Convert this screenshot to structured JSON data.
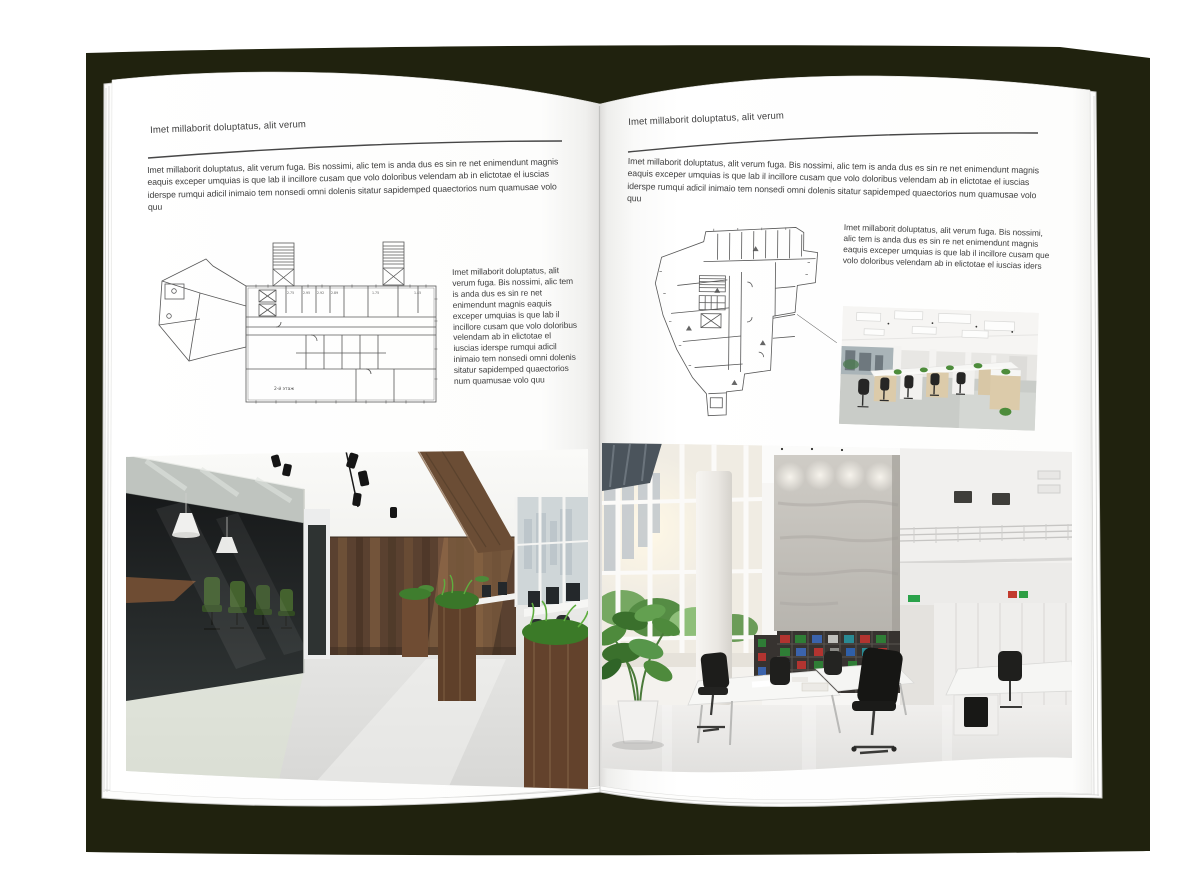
{
  "book": {
    "cover_color": "#20220e",
    "page_color": "#ffffff",
    "rule_color": "#474747",
    "text_color": "#404040"
  },
  "left_page": {
    "header": "Imet millaborit doluptatus, alit verum",
    "intro": "Imet millaborit doluptatus, alit verum fuga. Bis nossimi, alic tem is anda dus es sin re net enimendunt magnis eaquis exceper umquias is que lab il incillore cusam que volo doloribus velendam ab in elictotae el iuscias iderspe rumqui adicil inimaio tem nonsedi omni dolenis sitatur sapidemped quaectorios num quamusae volo quu",
    "side_text": "Imet millaborit doluptatus, alit verum fuga. Bis nossimi, alic tem is anda dus es sin re net enimendunt magnis eaquis exceper umquias is que lab il incillore cusam que volo doloribus velendam ab in elictotae el iuscias iderspe rumqui adicil inimaio tem nonsedi omni dolenis sitatur sapidemped quaectorios num quamusae volo quu",
    "plan_dimensions": [
      "2.75",
      "2.95",
      "2.92",
      "2.89",
      "1.75",
      "1.45"
    ],
    "plan_floor_label": "2-й этаж"
  },
  "right_page": {
    "header": "Imet millaborit doluptatus, alit verum",
    "intro": "Imet millaborit doluptatus, alit verum fuga. Bis nossimi, alic tem is anda dus es sin re net enimendunt magnis eaquis exceper umquias is que lab il incillore cusam que volo doloribus velendam ab in elictotae el iuscias iderspe rumqui adicil inimaio tem nonsedi omni dolenis sitatur sapidemped quaectorios num quamusae volo quu",
    "side_text": "Imet millaborit doluptatus, alit verum fuga. Bis nossimi, alic tem is anda dus es sin re net eni­mendunt magnis eaquis exceper umquias is que lab il incillore cusam que volo doloribus velendam ab in elictotae el iuscias iders"
  }
}
